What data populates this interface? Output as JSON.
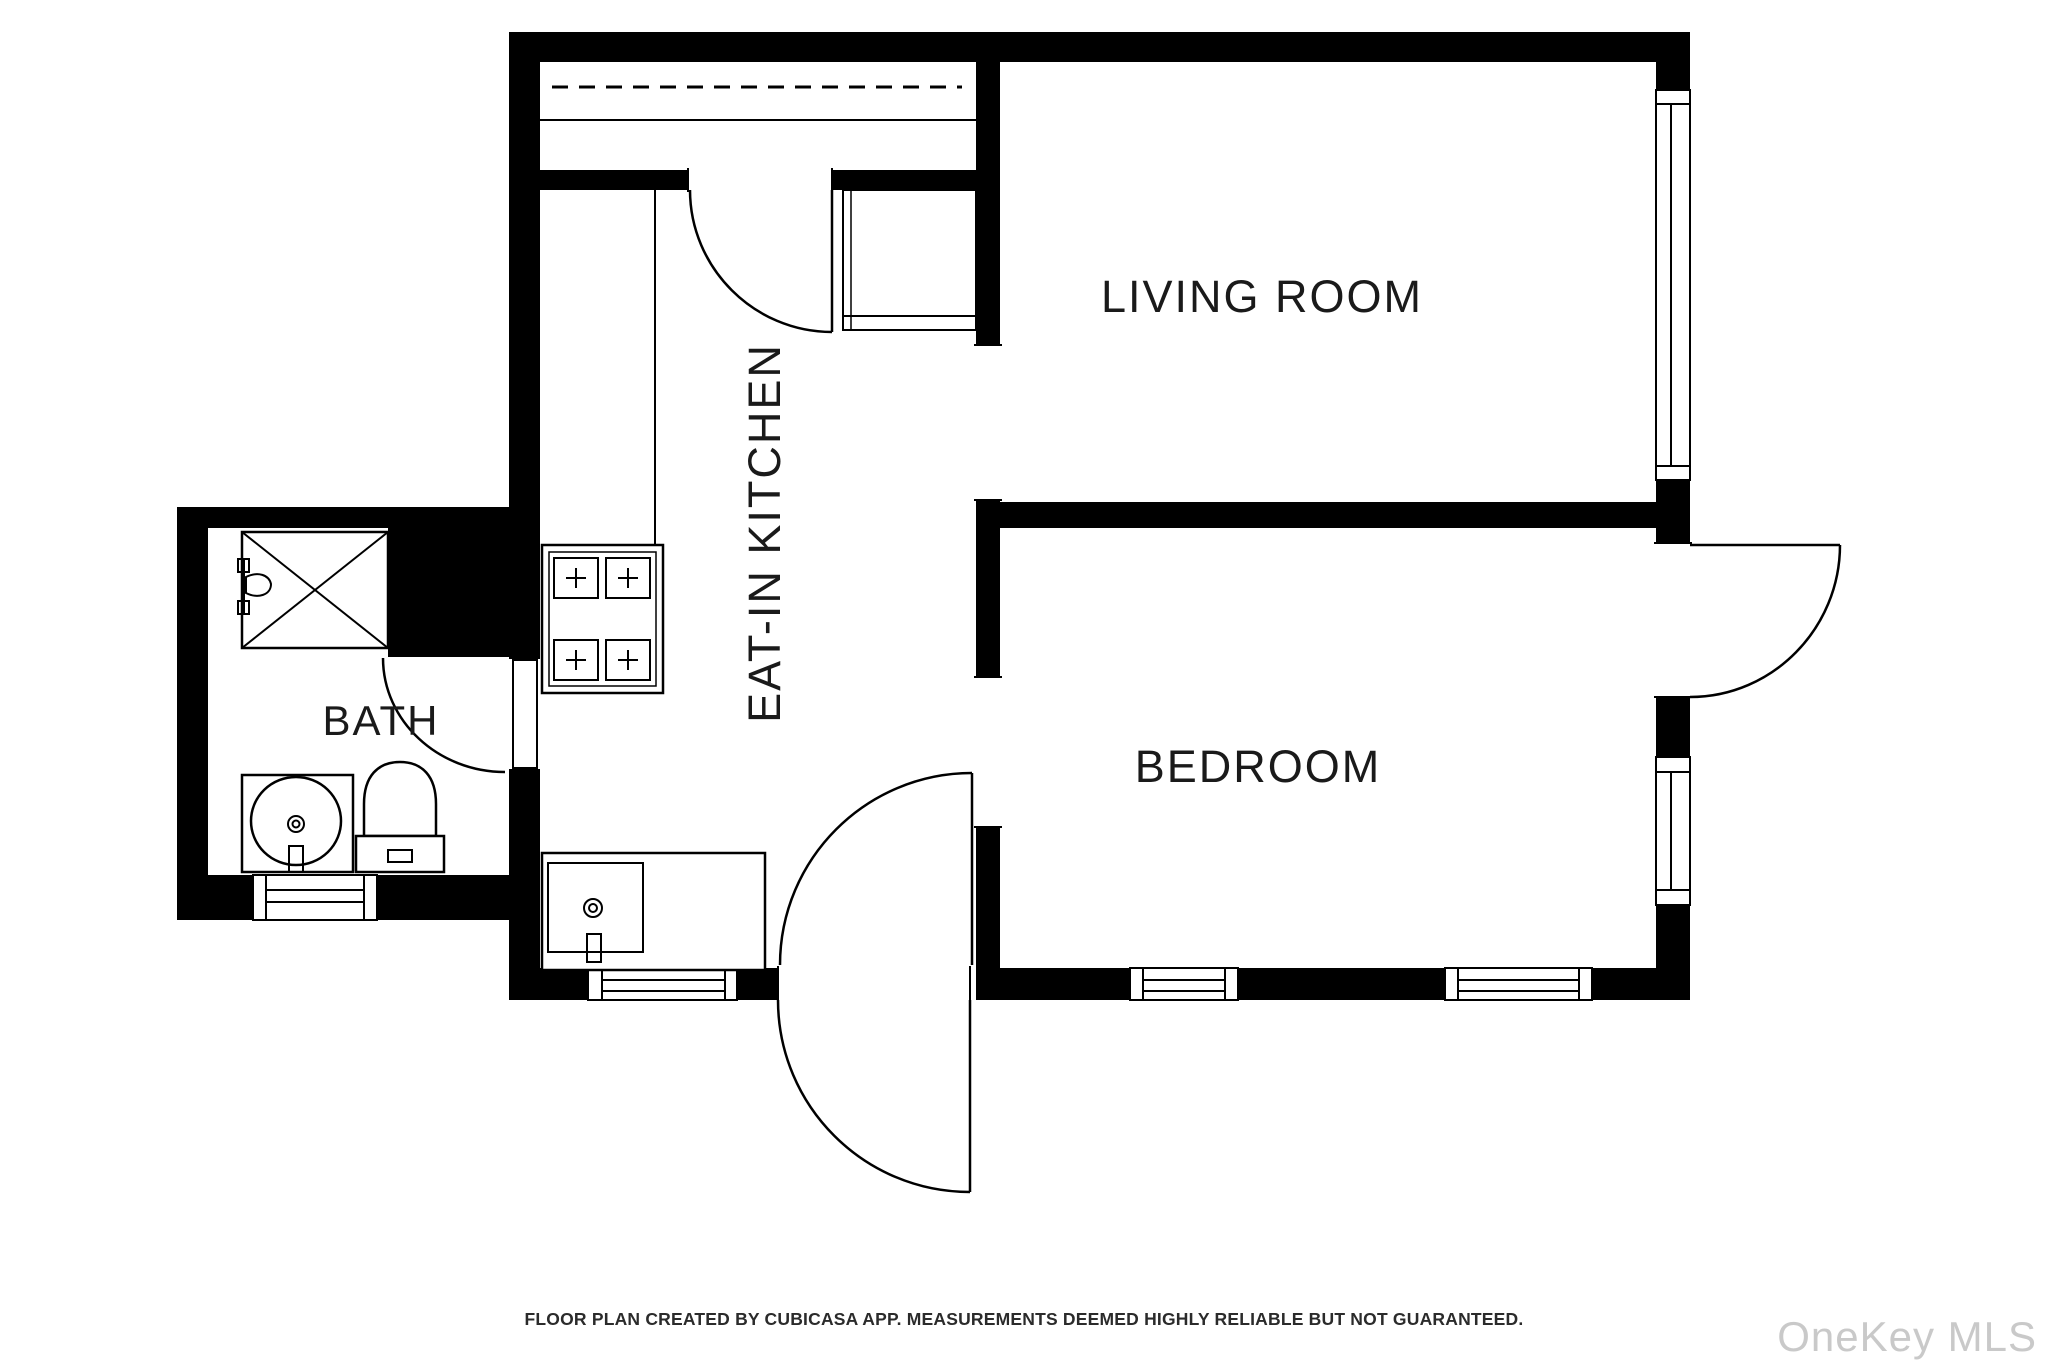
{
  "rooms": {
    "living_room": {
      "label": "LIVING ROOM"
    },
    "bedroom": {
      "label": "BEDROOM"
    },
    "kitchen": {
      "label": "EAT-IN KITCHEN"
    },
    "bath": {
      "label": "BATH"
    }
  },
  "fixtures": [
    "shower",
    "toilet",
    "bathroom-sink",
    "kitchen-sink",
    "stove",
    "closet-rail",
    "pantry-closet"
  ],
  "doors": [
    "kitchen-door",
    "bath-door",
    "bedroom-door",
    "entry-door",
    "living-room-side-door"
  ],
  "windows": [
    "living-room-window",
    "bedroom-right-window",
    "bath-window",
    "kitchen-window",
    "bedroom-bottom-window-1",
    "bedroom-bottom-window-2"
  ],
  "footer": {
    "disclaimer": "FLOOR PLAN CREATED BY CUBICASA APP. MEASUREMENTS DEEMED HIGHLY RELIABLE BUT NOT GUARANTEED."
  },
  "watermark": {
    "label": "OneKey MLS"
  },
  "colors": {
    "wall": "#000000",
    "background": "#ffffff",
    "line": "#000000",
    "label_text": "#1a1a1a",
    "footer_text": "#2b2b2b",
    "watermark_text": "#c9c9c9"
  }
}
